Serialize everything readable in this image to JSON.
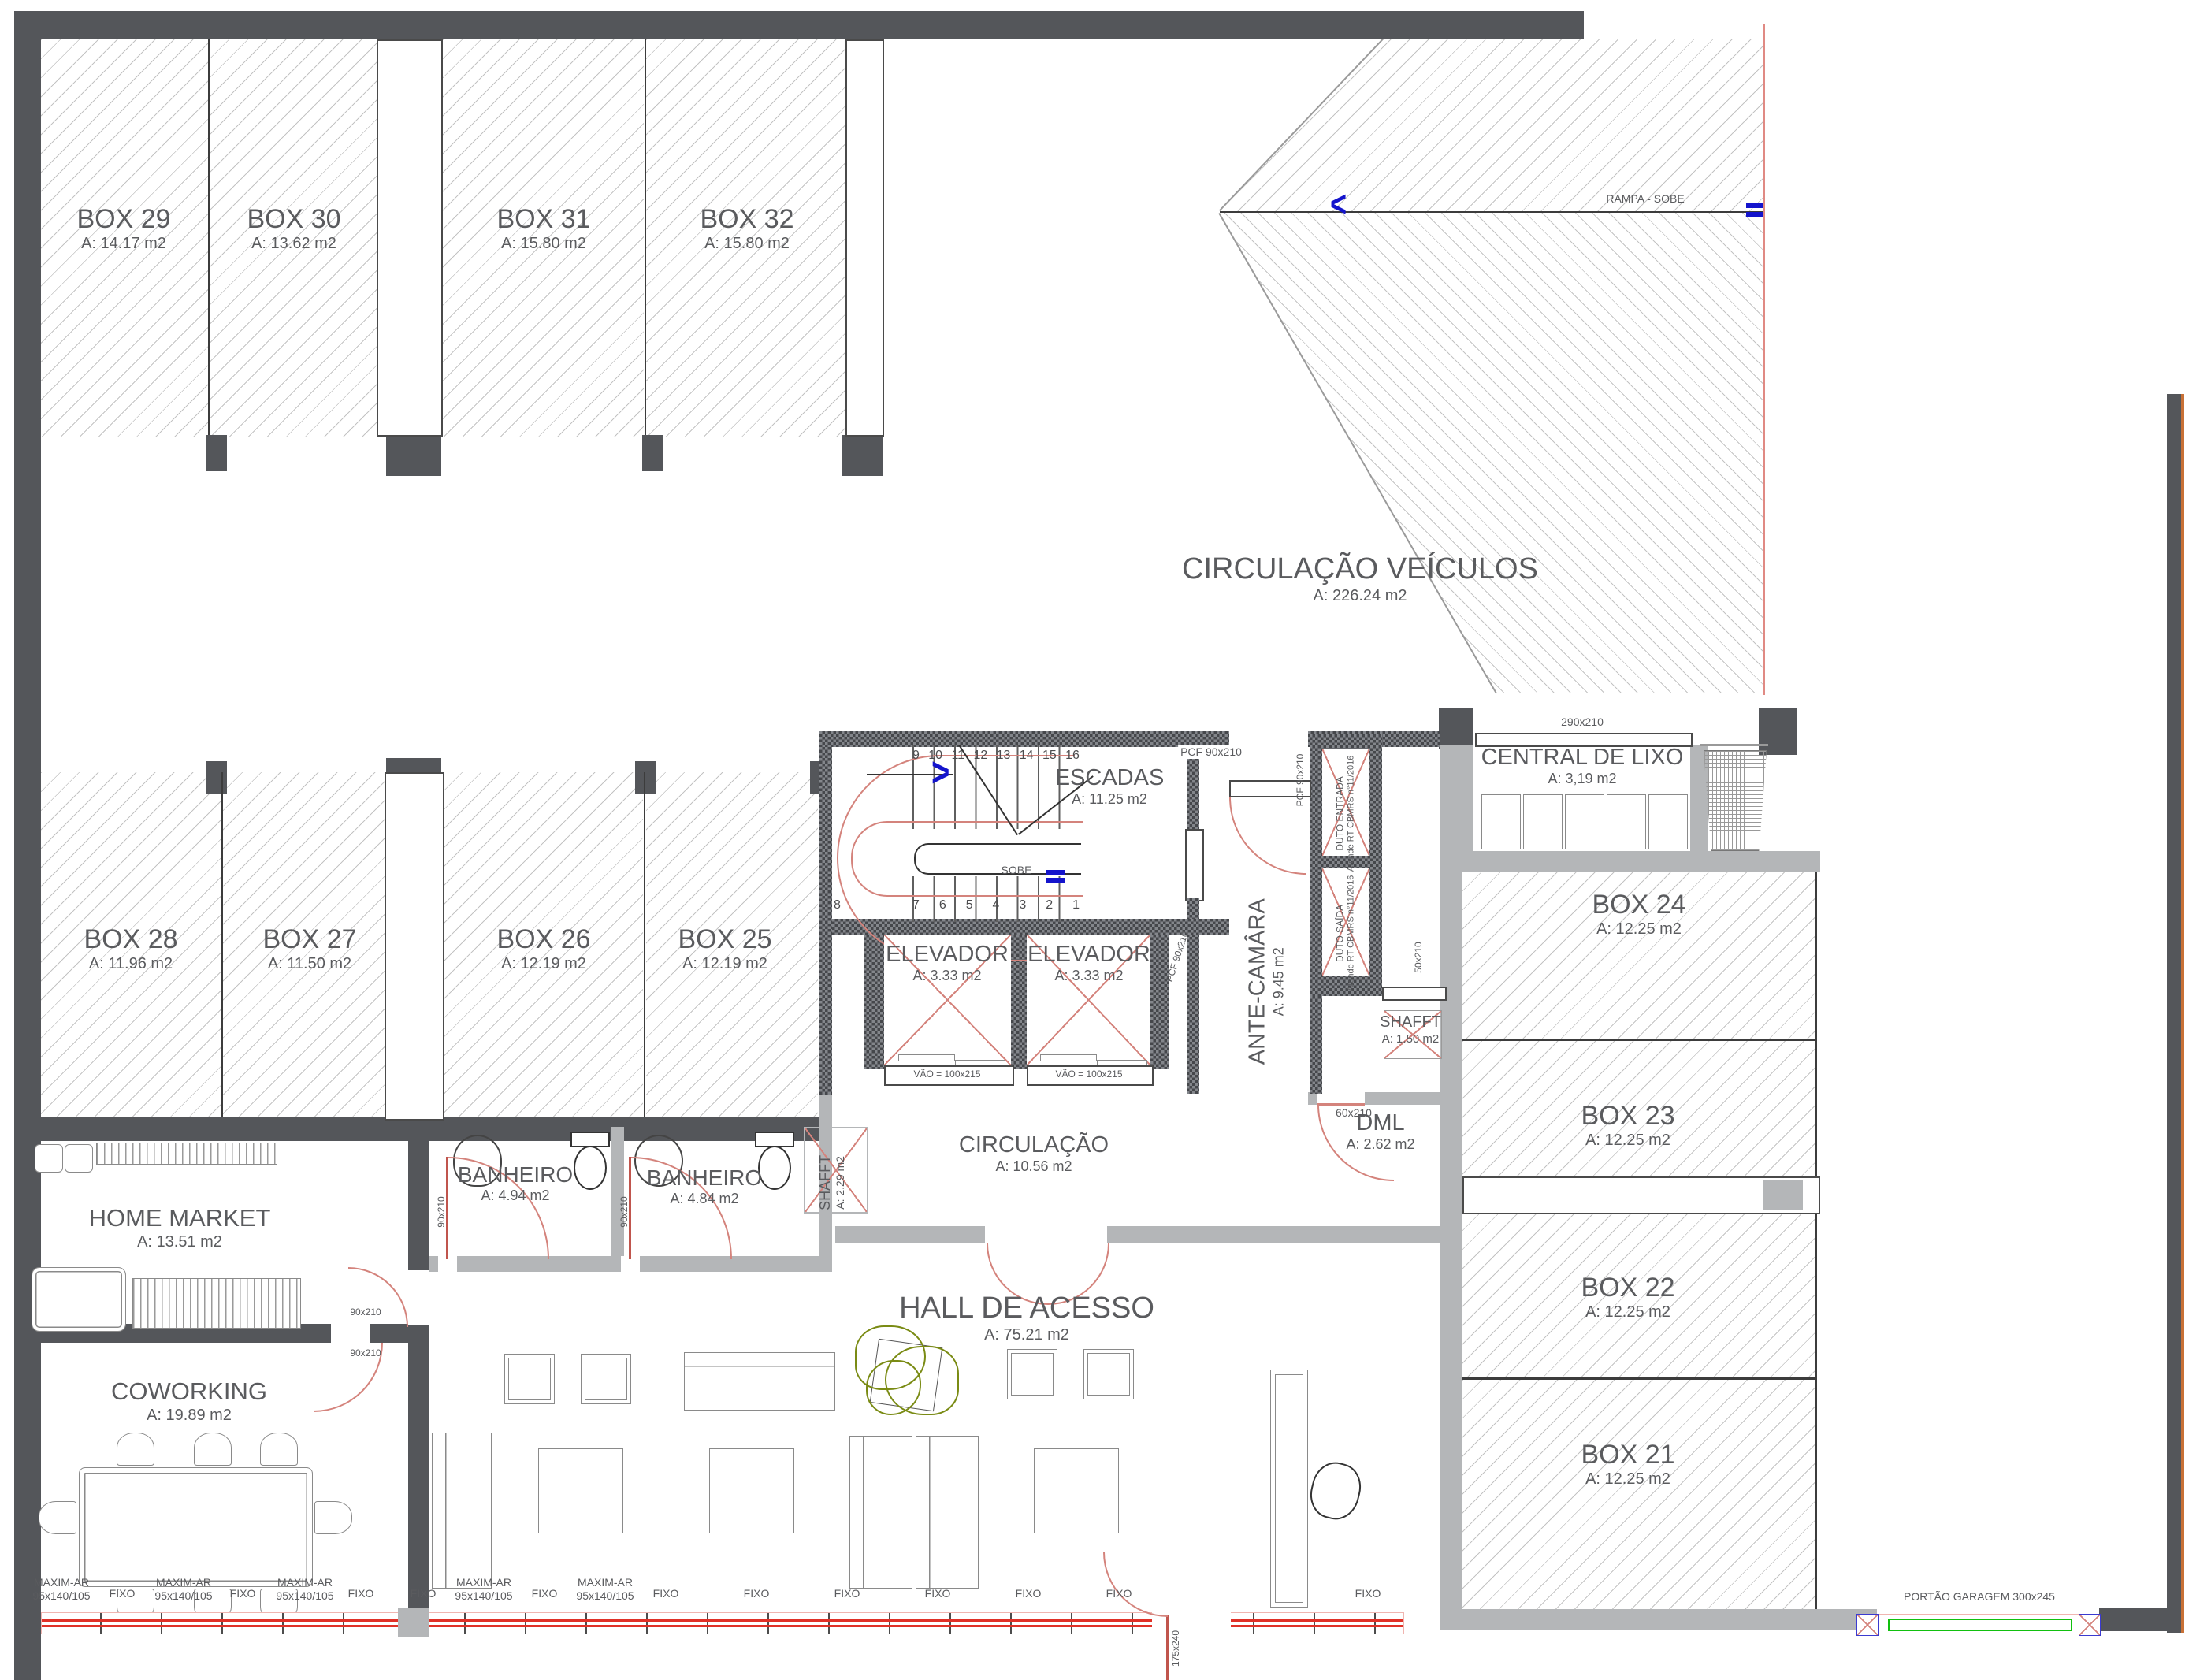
{
  "rooms": {
    "box29": {
      "name": "BOX 29",
      "area": "A: 14.17 m2"
    },
    "box30": {
      "name": "BOX 30",
      "area": "A: 13.62 m2"
    },
    "box31": {
      "name": "BOX 31",
      "area": "A: 15.80 m2"
    },
    "box32": {
      "name": "BOX 32",
      "area": "A: 15.80 m2"
    },
    "box28": {
      "name": "BOX 28",
      "area": "A: 11.96 m2"
    },
    "box27": {
      "name": "BOX 27",
      "area": "A: 11.50 m2"
    },
    "box26": {
      "name": "BOX 26",
      "area": "A: 12.19 m2"
    },
    "box25": {
      "name": "BOX 25",
      "area": "A: 12.19 m2"
    },
    "box24": {
      "name": "BOX 24",
      "area": "A: 12.25 m2"
    },
    "box23": {
      "name": "BOX 23",
      "area": "A: 12.25 m2"
    },
    "box22": {
      "name": "BOX 22",
      "area": "A: 12.25 m2"
    },
    "box21": {
      "name": "BOX 21",
      "area": "A: 12.25 m2"
    },
    "circulacao_veiculos": {
      "name": "CIRCULAÇÃO VEÍCULOS",
      "area": "A: 226.24 m2"
    },
    "escadas": {
      "name": "ESCADAS",
      "area": "A: 11.25 m2"
    },
    "elevador1": {
      "name": "ELEVADOR",
      "area": "A: 3.33 m2"
    },
    "elevador2": {
      "name": "ELEVADOR",
      "area": "A: 3.33 m2"
    },
    "ante_camara": {
      "name": "ANTE-CAMÂRA",
      "area": "A: 9.45 m2"
    },
    "shafft_small": {
      "name": "SHAFFT",
      "area": "A: 1.50 m2"
    },
    "shafft_tall": {
      "name": "SHAFFT",
      "area": "A: 2.29 m2"
    },
    "dml": {
      "name": "DML",
      "area": "A: 2.62 m2"
    },
    "circulacao": {
      "name": "CIRCULAÇÃO",
      "area": "A: 10.56 m2"
    },
    "central_lixo": {
      "name": "CENTRAL DE LIXO",
      "area": "A: 3,19 m2"
    },
    "banheiro1": {
      "name": "BANHEIRO",
      "area": "A: 4.94 m2"
    },
    "banheiro2": {
      "name": "BANHEIRO",
      "area": "A: 4.84 m2"
    },
    "home_market": {
      "name": "HOME MARKET",
      "area": "A: 13.51  m2"
    },
    "coworking": {
      "name": "COWORKING",
      "area": "A: 19.89 m2"
    },
    "hall": {
      "name": "HALL DE ACESSO",
      "area": "A: 75.21 m2"
    }
  },
  "stairs": {
    "sobe": "SOBE",
    "upper": [
      "9",
      "10",
      "11",
      "12",
      "13",
      "14",
      "15",
      "16"
    ],
    "lower_left": "8",
    "lower": [
      "7",
      "6",
      "5",
      "4",
      "3",
      "2",
      "1"
    ]
  },
  "ramp": {
    "label": "RAMPA - SOBE"
  },
  "doors": {
    "pcf": "PCF 90x210",
    "vao": "VÃO = 100x215",
    "d50": "50x210",
    "d60": "60x210",
    "d90": "90x210",
    "d290": "290x210",
    "d175": "175x240",
    "portao": "PORTÃO GARAGEM 300x245"
  },
  "ducts": {
    "duto_entrada": "DUTO ENTRADA",
    "duto_saida": "DUTO SAÍDA",
    "atende": "Atende RT CBMRS n°11/2016"
  },
  "windows": {
    "items": [
      {
        "label": "MAXIM-AR",
        "size": "95x140/105"
      },
      {
        "label": "FIXO"
      },
      {
        "label": "MAXIM-AR",
        "size": "95x140/105"
      },
      {
        "label": "FIXO"
      },
      {
        "label": "MAXIM-AR",
        "size": "95x140/105"
      },
      {
        "label": "FIXO"
      },
      {
        "label": "FIXO"
      },
      {
        "label": "MAXIM-AR",
        "size": "95x140/105"
      },
      {
        "label": "FIXO"
      },
      {
        "label": "MAXIM-AR",
        "size": "95x140/105"
      },
      {
        "label": "FIXO"
      },
      {
        "label": "FIXO"
      },
      {
        "label": "FIXO"
      },
      {
        "label": "FIXO"
      },
      {
        "label": "FIXO"
      },
      {
        "label": "FIXO"
      },
      {
        "label": "FIXO"
      }
    ]
  },
  "colors": {
    "wall_dark": "#54565a",
    "wall_gray": "#b4b6b8",
    "door_arc_red": "#d4837c",
    "window_red": "#e03127",
    "accent_blue": "#1414cc",
    "garage_green": "#12c00f",
    "plant_green": "#7a8b14",
    "hatch_gray": "#c3c3c3"
  }
}
